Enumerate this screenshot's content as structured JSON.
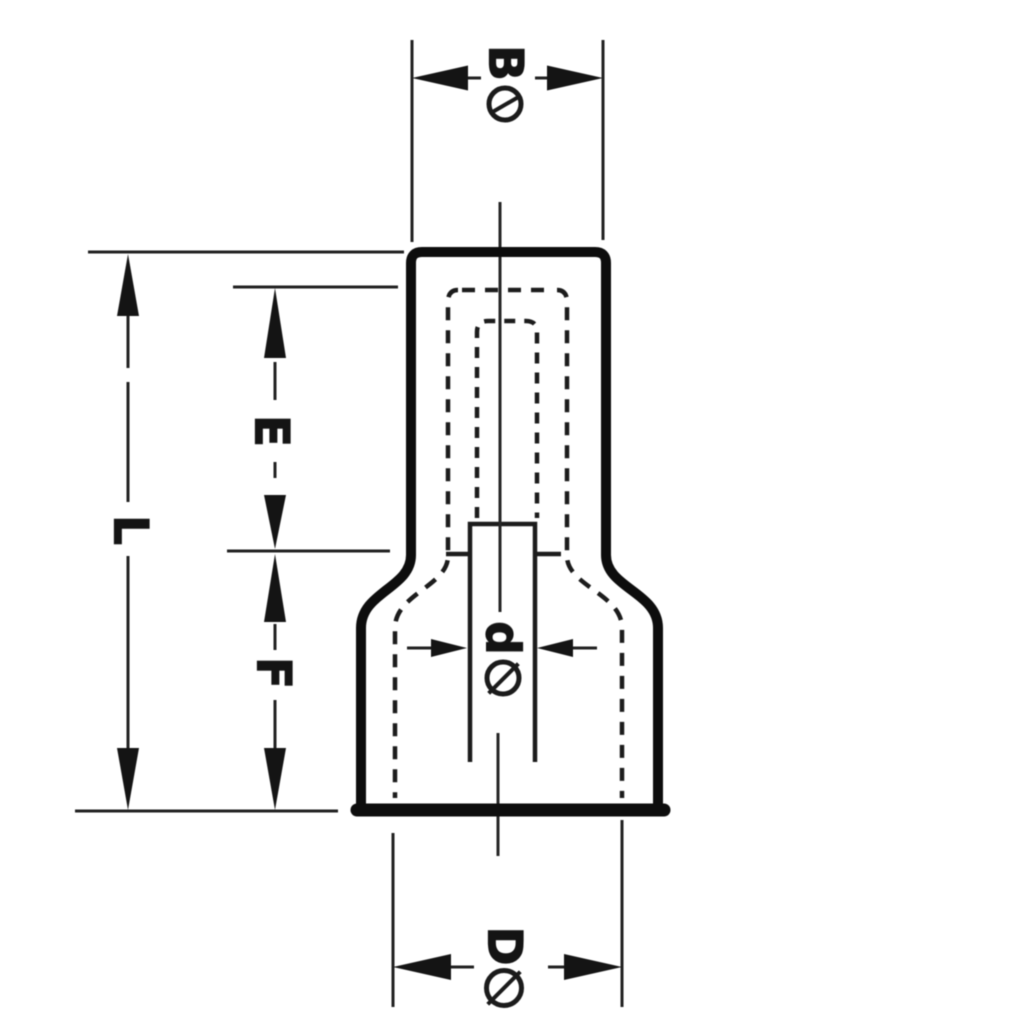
{
  "drawing": {
    "kind": "technical-drawing",
    "subject": "closed-end connector cross-section with dimension callouts",
    "ink_color": "#141414",
    "paper_color": "#ffffff",
    "diameter_symbol": "slashed-circle",
    "labels": {
      "B": "B",
      "L": "L",
      "E": "E",
      "F": "F",
      "d": "d",
      "D": "D"
    }
  }
}
